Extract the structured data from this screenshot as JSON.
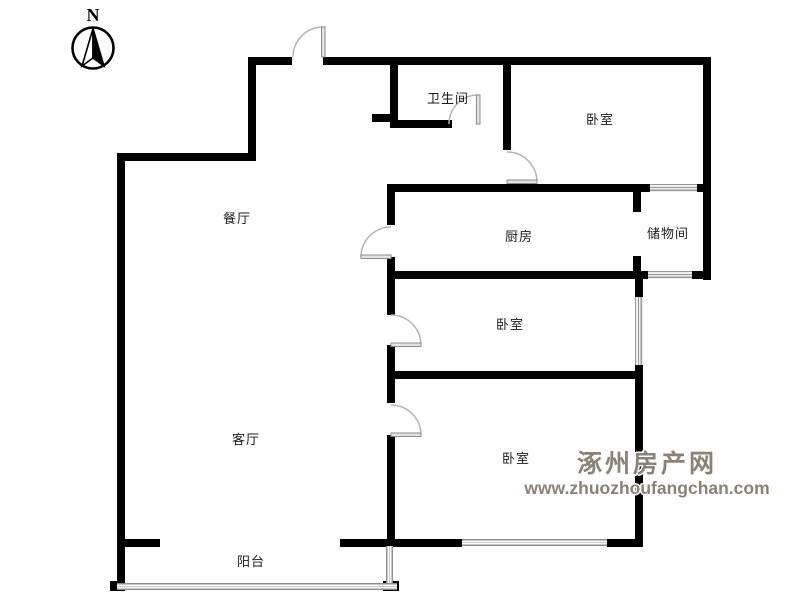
{
  "compass": {
    "label": "N",
    "icon": "compass-north-arrow"
  },
  "rooms": [
    {
      "id": "bathroom",
      "label": "卫生间"
    },
    {
      "id": "bedroom-top",
      "label": "卧室"
    },
    {
      "id": "dining-room",
      "label": "餐厅"
    },
    {
      "id": "kitchen",
      "label": "厨房"
    },
    {
      "id": "storage-room",
      "label": "储物间"
    },
    {
      "id": "bedroom-middle",
      "label": "卧室"
    },
    {
      "id": "living-room",
      "label": "客厅"
    },
    {
      "id": "bedroom-bottom",
      "label": "卧室"
    },
    {
      "id": "balcony",
      "label": "阳台"
    }
  ],
  "watermark": {
    "site_name": "涿州房产网",
    "site_url": "www.zhuozhoufangchan.com"
  },
  "colors": {
    "wall": "#000000",
    "door": "#b5b5b5",
    "window_line": "#9a9a9a",
    "watermark": "#8a8177",
    "label_text": "#1a1a1a"
  }
}
